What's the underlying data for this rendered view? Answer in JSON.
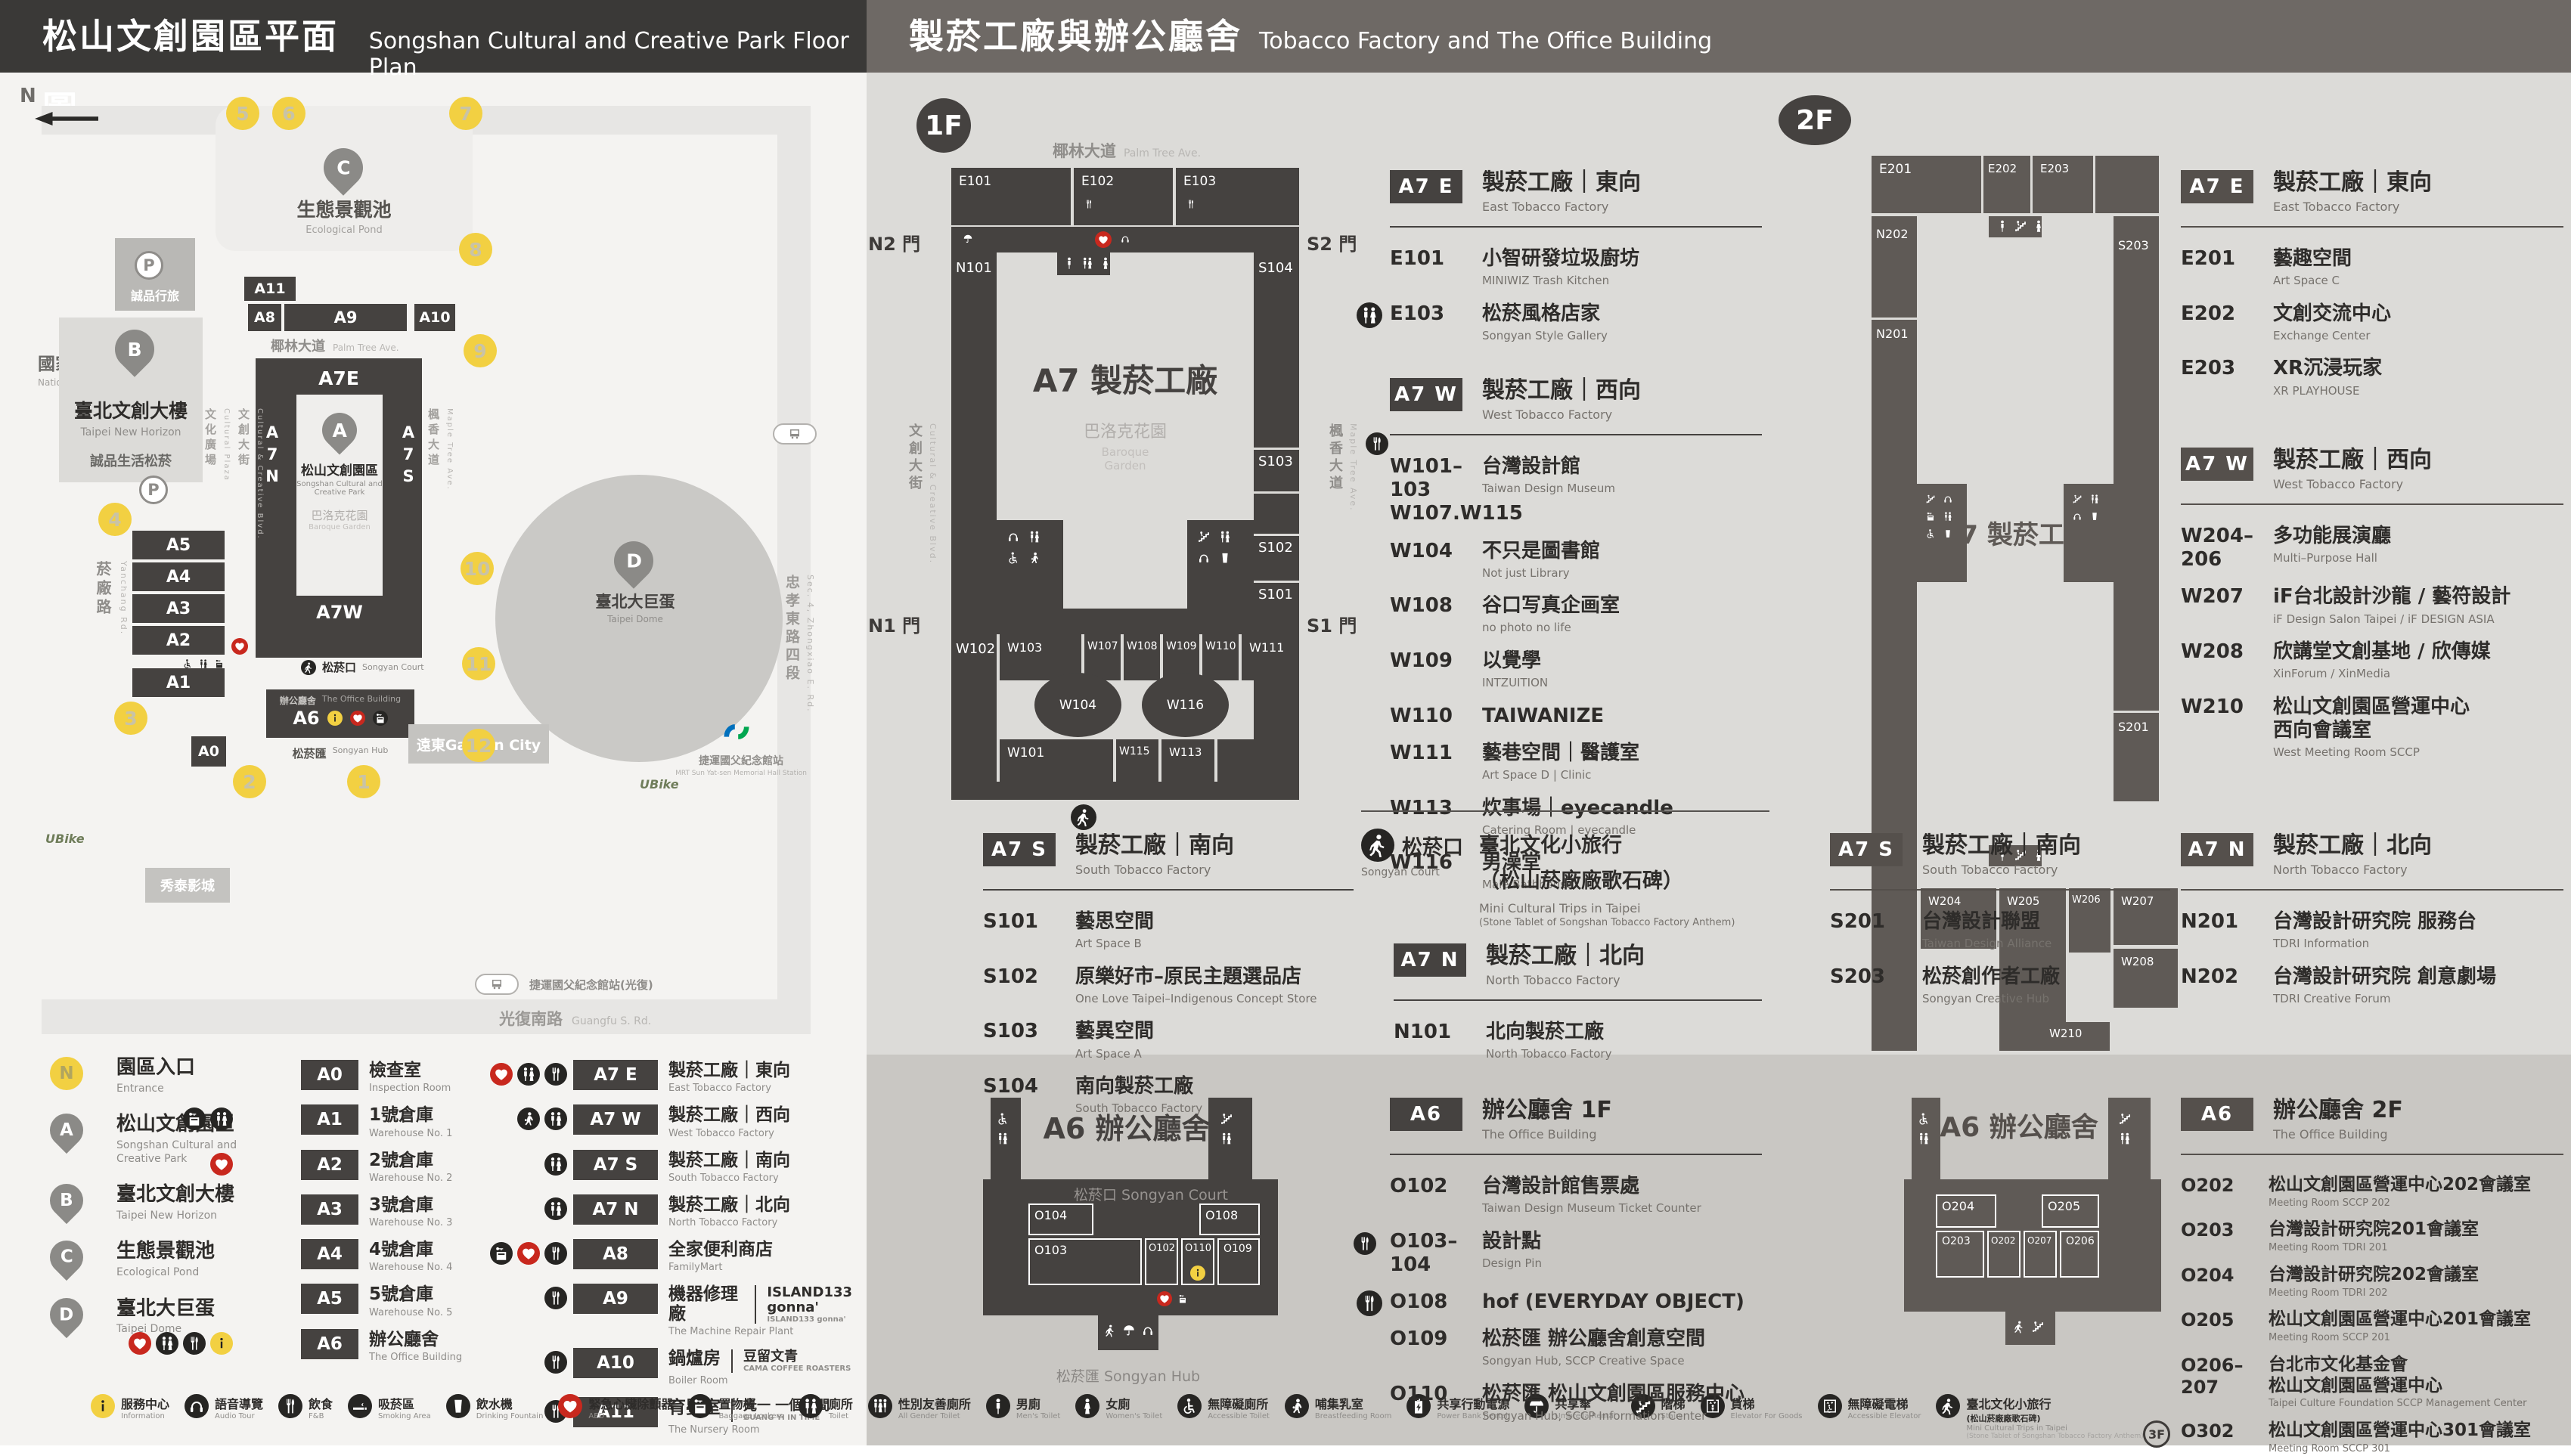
{
  "header": {
    "left": {
      "zh": "松山文創園區平面圖",
      "en": "Songshan Cultural and Creative Park Floor Plan"
    },
    "right": {
      "zh": "製菸工廠與辦公廳舍",
      "en": "Tobacco Factory and The Office Building"
    }
  },
  "map": {
    "compass": "N",
    "parking": "P",
    "landmarks": {
      "rail": {
        "zh": "國家鐵道博物館",
        "en": "National Railway Museum"
      },
      "hotel": {
        "zh": "誠品行旅"
      },
      "bbuild": {
        "zh": "臺北文創大樓",
        "en": "Taipei New Horizon",
        "sub": "誠品生活松菸"
      },
      "pond": {
        "zh": "生態景觀池",
        "en": "Ecological Pond"
      },
      "park": {
        "zh": "松山文創園區",
        "en": "Songshan Cultural and",
        "en2": "Creative Park"
      },
      "garden": {
        "zh": "巴洛克花園",
        "en": "Baroque Garden"
      },
      "dome": {
        "zh": "臺北大巨蛋",
        "en": "Taipei Dome"
      },
      "court": {
        "zh": "松菸口",
        "en": "Songyan Court"
      },
      "office": {
        "zh": "辦公廳舍",
        "en": "The Office Building"
      },
      "hub": {
        "zh": "松菸匯",
        "en": "Songyan Hub"
      },
      "cinema": {
        "zh": "秀泰影城"
      },
      "gcity": {
        "zh": "遠東Garden City"
      },
      "mrt": {
        "zh": "捷運國父紀念館站",
        "en": "MRT Sun Yat-sen Memorial Hall Station"
      },
      "bus": {
        "zh": "捷運國父紀念館站(光復)"
      },
      "ubike": "UBike"
    },
    "streets": {
      "yanchang": {
        "zh": "菸廠路",
        "en": "Yanchang Rd."
      },
      "plaza": {
        "zh": "文化廣場",
        "en": "Cultural Plaza"
      },
      "blvd": {
        "zh": "文創大街",
        "en": "Cultural & Creative Blvd."
      },
      "maple": {
        "zh": "楓香大道",
        "en": "Maple Tree Ave."
      },
      "palm": {
        "zh": "椰林大道",
        "en": "Palm Tree Ave."
      },
      "guangfu": {
        "zh": "光復南路",
        "en": "Guangfu S. Rd."
      },
      "zhongxiao": {
        "zh": "忠孝東路四段",
        "en": "Sec. 4, Zhongxiao E. Rd."
      }
    },
    "blocks": [
      "A11",
      "A8",
      "A9",
      "A10",
      "A5",
      "A4",
      "A3",
      "A2",
      "A1",
      "A0",
      "A6"
    ],
    "a7e": "A7E",
    "a7w": "A7W",
    "a7n": "A7N",
    "a7s": "A7S",
    "entrances": [
      "1",
      "2",
      "3",
      "4",
      "5",
      "6",
      "7",
      "8",
      "9",
      "10",
      "11",
      "12"
    ]
  },
  "legend": {
    "places": [
      {
        "marker": "N",
        "type": "circle",
        "zh": "園區入口",
        "en": "Entrance"
      },
      {
        "marker": "A",
        "type": "pin",
        "zh": "松山文創園區",
        "en": "Songshan Cultural and Creative Park"
      },
      {
        "marker": "B",
        "type": "pin",
        "zh": "臺北文創大樓",
        "en": "Taipei New Horizon"
      },
      {
        "marker": "C",
        "type": "pin",
        "zh": "生態景觀池",
        "en": "Ecological Pond"
      },
      {
        "marker": "D",
        "type": "pin",
        "zh": "臺北大巨蛋",
        "en": "Taipei Dome"
      }
    ],
    "col1": [
      {
        "code": "A0",
        "zh": "檢查室",
        "en": "Inspection Room",
        "icons": []
      },
      {
        "code": "A1",
        "zh": "1號倉庫",
        "en": "Warehouse No. 1",
        "icons": [
          "locker",
          "toilet"
        ]
      },
      {
        "code": "A2",
        "zh": "2號倉庫",
        "en": "Warehouse No. 2",
        "icons": [
          "aed"
        ]
      },
      {
        "code": "A3",
        "zh": "3號倉庫",
        "en": "Warehouse No. 3",
        "icons": []
      },
      {
        "code": "A4",
        "zh": "4號倉庫",
        "en": "Warehouse No. 4",
        "icons": []
      },
      {
        "code": "A5",
        "zh": "5號倉庫",
        "en": "Warehouse No. 5",
        "icons": []
      },
      {
        "code": "A6",
        "zh": "辦公廳舍",
        "en": "The Office Building",
        "icons": [
          "aed",
          "toilet",
          "fnb",
          "info"
        ]
      }
    ],
    "col2": [
      {
        "code": "A7 E",
        "zh": "製菸工廠｜東向",
        "en": "East Tobacco Factory",
        "icons": [
          "aed",
          "toilet",
          "fnb"
        ]
      },
      {
        "code": "A7 W",
        "zh": "製菸工廠｜西向",
        "en": "West Tobacco Factory",
        "icons": [
          "nursing",
          "toilet"
        ]
      },
      {
        "code": "A7 S",
        "zh": "製菸工廠｜南向",
        "en": "South Tobacco Factory",
        "icons": [
          "toilet"
        ]
      },
      {
        "code": "A7 N",
        "zh": "製菸工廠｜北向",
        "en": "North Tobacco Factory",
        "icons": [
          "toilet"
        ]
      },
      {
        "code": "A8",
        "zh": "全家便利商店",
        "en": "FamilyMart",
        "icons": [
          "locker",
          "aed",
          "fnb"
        ]
      },
      {
        "code": "A9",
        "zh": "機器修理廠",
        "en": "The Machine Repair Plant",
        "icons": [
          "fnb"
        ],
        "extra_zh": "ISLAND133 gonna'",
        "extra_en": "ISLAND133 gonna'"
      },
      {
        "code": "A10",
        "zh": "鍋爐房",
        "en": "Boiler Room",
        "icons": [
          "fnb"
        ],
        "extra_zh": "豆留文青",
        "extra_en": "CAMA COFFEE ROASTERS"
      },
      {
        "code": "A11",
        "zh": "育嬰室",
        "en": "The Nursery Room",
        "icons": [
          "fnb"
        ],
        "extra_zh": "光一 一個時間",
        "extra_en": "GUANG YI IN TIME"
      }
    ]
  },
  "facilities": [
    {
      "icon": "info",
      "zh": "服務中心",
      "en": "Information"
    },
    {
      "icon": "audio",
      "zh": "語音導覽",
      "en": "Audio Tour"
    },
    {
      "icon": "fnb",
      "zh": "飲食",
      "en": "F&B"
    },
    {
      "icon": "smoking",
      "zh": "吸菸區",
      "en": "Smoking Area"
    },
    {
      "icon": "water",
      "zh": "飲水機",
      "en": "Drinking Fountain"
    },
    {
      "icon": "aed",
      "zh": "緊急心臟除顫器",
      "en": "AED"
    },
    {
      "icon": "locker",
      "zh": "置物櫃",
      "en": "Baggage Lockers"
    },
    {
      "icon": "toilet",
      "zh": "廁所",
      "en": "Toilet"
    },
    {
      "icon": "allgender",
      "zh": "性別友善廁所",
      "en": "All Gender Toilet"
    },
    {
      "icon": "men",
      "zh": "男廁",
      "en": "Men's Toilet"
    },
    {
      "icon": "women",
      "zh": "女廁",
      "en": "Women's Toilet"
    },
    {
      "icon": "wheelchair",
      "zh": "無障礙廁所",
      "en": "Accessible Toilet"
    },
    {
      "icon": "nursing",
      "zh": "哺集乳室",
      "en": "Breastfeeding Room"
    },
    {
      "icon": "powerbank",
      "zh": "共享行動電源",
      "en": "Power Bank Rental"
    },
    {
      "icon": "umbrella",
      "zh": "共享傘",
      "en": "Umbrella Rental"
    },
    {
      "icon": "stairs",
      "zh": "階梯",
      "en": "Stairs"
    },
    {
      "icon": "liftgoods",
      "zh": "貨梯",
      "en": "Elevator For Goods"
    },
    {
      "icon": "liftacc",
      "zh": "無障礙電梯",
      "en": "Accessible Elevator"
    },
    {
      "icon": "walk",
      "zh": "臺北文化小旅行",
      "zh2": "(松山菸廠廠歌石碑)",
      "en": "Mini Cultural Trips in Taipei",
      "en2": "(Stone Tablet of Songshan Tobacco Factory Anthem)"
    }
  ],
  "f1": {
    "badge": "1F",
    "plan": {
      "center": "A7 製菸工廠",
      "garden_zh": "巴洛克花園",
      "garden_en": "Baroque Garden",
      "gates": {
        "n2": "N2 門",
        "s2": "S2 門",
        "n1": "N1 門",
        "s1": "S1 門"
      },
      "rooms": [
        "E101",
        "E102",
        "E103",
        "N101",
        "S104",
        "S103",
        "S102",
        "S101",
        "W102",
        "W103",
        "W107",
        "W108",
        "W109",
        "W110",
        "W111",
        "W104",
        "W116",
        "W101",
        "W115",
        "W113"
      ]
    },
    "a7e": {
      "badge": "A7 E",
      "zh": "製菸工廠｜東向",
      "en": "East Tobacco Factory",
      "items": [
        {
          "code": "E101",
          "zh": "小智研發垃圾廚坊",
          "en": "MINIWIZ Trash Kitchen"
        },
        {
          "code": "E103",
          "zh": "松菸風格店家",
          "en": "Songyan Style Gallery",
          "icon": "toilet"
        }
      ]
    },
    "a7w": {
      "badge": "A7 W",
      "zh": "製菸工廠｜西向",
      "en": "West Tobacco Factory",
      "items": [
        {
          "code": "W101–103",
          "code2": "W107.W115",
          "zh": "台灣設計館",
          "en": "Taiwan Design Museum"
        },
        {
          "code": "W104",
          "zh": "不只是圖書館",
          "en": "Not just Library"
        },
        {
          "code": "W108",
          "zh": "谷口写真企画室",
          "en": "no photo no life"
        },
        {
          "code": "W109",
          "zh": "以覺學",
          "en": "INTZUITION"
        },
        {
          "code": "W110",
          "zh": "TAIWANIZE"
        },
        {
          "code": "W111",
          "zh": "藝巷空間｜醫護室",
          "en": "Art Space D | Clinic"
        },
        {
          "code": "W113",
          "zh": "炊事場｜eyecandle",
          "en": "Catering Room | eyecandle"
        },
        {
          "code": "W116",
          "zh": "男澡堂",
          "en": "Male Bathhouse"
        }
      ]
    },
    "a7s": {
      "badge": "A7 S",
      "zh": "製菸工廠｜南向",
      "en": "South Tobacco Factory",
      "items": [
        {
          "code": "S101",
          "zh": "藝思空間",
          "en": "Art Space B"
        },
        {
          "code": "S102",
          "zh": "原樂好市–原民主題選品店",
          "en": "One Love Taipei–Indigenous Concept Store"
        },
        {
          "code": "S103",
          "zh": "藝異空間",
          "en": "Art Space A"
        },
        {
          "code": "S104",
          "zh": "南向製菸工廠",
          "en": "South Tobacco Factory"
        }
      ]
    },
    "court": {
      "zh": "松菸口",
      "en": "Songyan Court",
      "t_zh": "臺北文化小旅行",
      "t_zh2": "（松山菸廠廠歌石碑）",
      "t_en": "Mini Cultural Trips in Taipei",
      "t_en2": "(Stone Tablet of Songshan Tobacco Factory Anthem)"
    },
    "a7n": {
      "badge": "A7 N",
      "zh": "製菸工廠｜北向",
      "en": "North Tobacco Factory",
      "items": [
        {
          "code": "N101",
          "zh": "北向製菸工廠",
          "en": "North Tobacco Factory"
        }
      ]
    },
    "a6plan": {
      "title": "A6 辦公廳舍",
      "court": "松菸口 Songyan Court",
      "hub": "松菸匯 Songyan Hub",
      "rooms": [
        "O104",
        "O103",
        "O102",
        "O110",
        "O109",
        "O108"
      ]
    },
    "a6": {
      "badge": "A6",
      "zh": "辦公廳舍 1F",
      "en": "The Office Building",
      "items": [
        {
          "code": "O102",
          "zh": "台灣設計館售票處",
          "en": "Taiwan Design Museum Ticket Counter"
        },
        {
          "code": "O103–104",
          "zh": "設計點",
          "en": "Design Pin"
        },
        {
          "code": "O108",
          "zh": "hof (EVERYDAY OBJECT)",
          "icon": "fnb"
        },
        {
          "code": "O109",
          "zh": "松菸匯 辦公廳舍創意空間",
          "en": "Songyan Hub, SCCP Creative Space"
        },
        {
          "code": "O110",
          "zh": "松菸匯 松山文創園區服務中心",
          "en": "Songyan Hub, SCCP Information Center"
        }
      ]
    }
  },
  "f2": {
    "badge": "2F",
    "plan": {
      "center": "A7 製菸工廠",
      "rooms": [
        "E201",
        "E202",
        "E203",
        "N202",
        "N201",
        "S203",
        "S201",
        "W204",
        "W205",
        "W206",
        "W207",
        "W208",
        "W210"
      ]
    },
    "a7e": {
      "badge": "A7 E",
      "zh": "製菸工廠｜東向",
      "en": "East Tobacco Factory",
      "items": [
        {
          "code": "E201",
          "zh": "藝趣空間",
          "en": "Art Space C"
        },
        {
          "code": "E202",
          "zh": "文創交流中心",
          "en": "Exchange Center"
        },
        {
          "code": "E203",
          "zh": "XR沉浸玩家",
          "en": "XR PLAYHOUSE"
        }
      ]
    },
    "a7w": {
      "badge": "A7 W",
      "zh": "製菸工廠｜西向",
      "en": "West Tobacco Factory",
      "items": [
        {
          "code": "W204–206",
          "zh": "多功能展演廳",
          "en": "Multi–Purpose Hall"
        },
        {
          "code": "W207",
          "zh": "iF台北設計沙龍 / 藝符設計",
          "en": "iF Design Salon Taipei / iF DESIGN ASIA"
        },
        {
          "code": "W208",
          "zh": "欣講堂文創基地 / 欣傳媒",
          "en": "XinForum / XinMedia"
        },
        {
          "code": "W210",
          "zh": "松山文創園區營運中心",
          "zh2": "西向會議室",
          "en": "West Meeting Room SCCP"
        }
      ]
    },
    "a7s": {
      "badge": "A7 S",
      "zh": "製菸工廠｜南向",
      "en": "South Tobacco Factory",
      "items": [
        {
          "code": "S201",
          "zh": "台灣設計聯盟",
          "en": "Taiwan Design Alliance"
        },
        {
          "code": "S203",
          "zh": "松菸創作者工廠",
          "en": "Songyan Creative Hub"
        }
      ]
    },
    "a7n": {
      "badge": "A7 N",
      "zh": "製菸工廠｜北向",
      "en": "North Tobacco Factory",
      "items": [
        {
          "code": "N201",
          "zh": "台灣設計研究院 服務台",
          "en": "TDRI Information"
        },
        {
          "code": "N202",
          "zh": "台灣設計研究院 創意劇場",
          "en": "TDRI Creative Forum"
        }
      ]
    },
    "a6plan": {
      "title": "A6 辦公廳舍",
      "rooms": [
        "O204",
        "O205",
        "O203",
        "O202",
        "O207",
        "O206"
      ]
    },
    "a6": {
      "badge": "A6",
      "zh": "辦公廳舍 2F",
      "en": "The Office Building",
      "items": [
        {
          "code": "O202",
          "zh": "松山文創園區營運中心202會議室",
          "en": "Meeting Room SCCP 202"
        },
        {
          "code": "O203",
          "zh": "台灣設計研究院201會議室",
          "en": "Meeting Room TDRI 201"
        },
        {
          "code": "O204",
          "zh": "台灣設計研究院202會議室",
          "en": "Meeting Room TDRI 202"
        },
        {
          "code": "O205",
          "zh": "松山文創園區營運中心201會議室",
          "en": "Meeting Room SCCP 201"
        },
        {
          "code": "O206–207",
          "zh": "台北市文化基金會",
          "zh2": "松山文創園區營運中心",
          "en": "Taipei Culture Foundation SCCP Management Center"
        },
        {
          "code": "O302",
          "zh": "松山文創園區營運中心301會議室",
          "en": "Meeting Room SCCP 301",
          "floor": "3F"
        }
      ]
    }
  }
}
